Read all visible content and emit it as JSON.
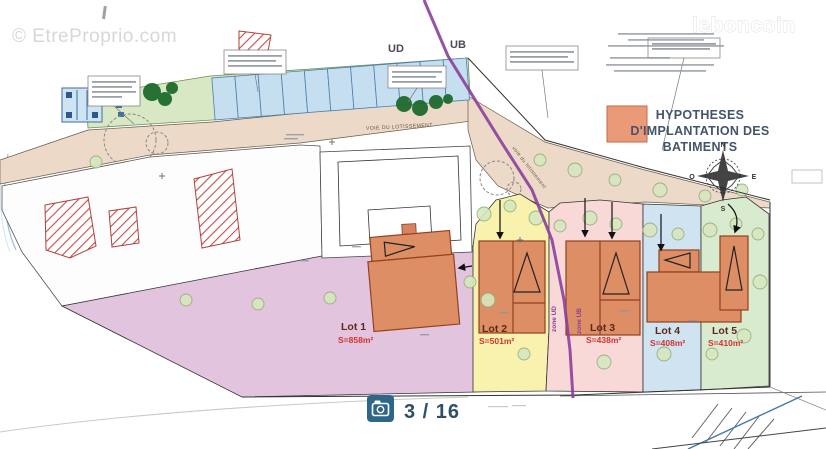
{
  "watermarks": {
    "top_left": "© EtreProprio.com",
    "top_right": "leboncoin"
  },
  "pager": {
    "counter": "3 / 16",
    "icon": "camera-icon"
  },
  "legend": {
    "lines": [
      "HYPOTHESES",
      "D'IMPLANTATION DES",
      "BATIMENTS"
    ],
    "swatch_color": "#eb9a78"
  },
  "zones": {
    "left": "UD",
    "right": "UB",
    "boundary_left_label": "zone UD",
    "boundary_right_label": "zone UB",
    "boundary_color": "#8b3f9b"
  },
  "roads": {
    "main": "VOIE DU LOTISSEMENT",
    "secondary": "voie du lotissement"
  },
  "compass": {
    "north": "N",
    "east": "E",
    "south": "S",
    "west": "O"
  },
  "lots": [
    {
      "name": "Lot 1",
      "surface": "S=858m²",
      "fill": "#e3c4de"
    },
    {
      "name": "Lot 2",
      "surface": "S=501m²",
      "fill": "#f8f2ae"
    },
    {
      "name": "Lot 3",
      "surface": "S=438m²",
      "fill": "#f8d9d8"
    },
    {
      "name": "Lot 4",
      "surface": "S=408m²",
      "fill": "#cfe3f1"
    },
    {
      "name": "Lot 5",
      "surface": "S=410m²",
      "fill": "#d9ebcf"
    }
  ],
  "colors": {
    "building_fill": "#dd8e65",
    "road_fill": "#ecd9c8",
    "green_strip": "#d8e7c4",
    "parking_fill": "#c6dff0",
    "existing_building_hatch": "#c0504d",
    "pager_icon_bg": "#2e6688"
  }
}
